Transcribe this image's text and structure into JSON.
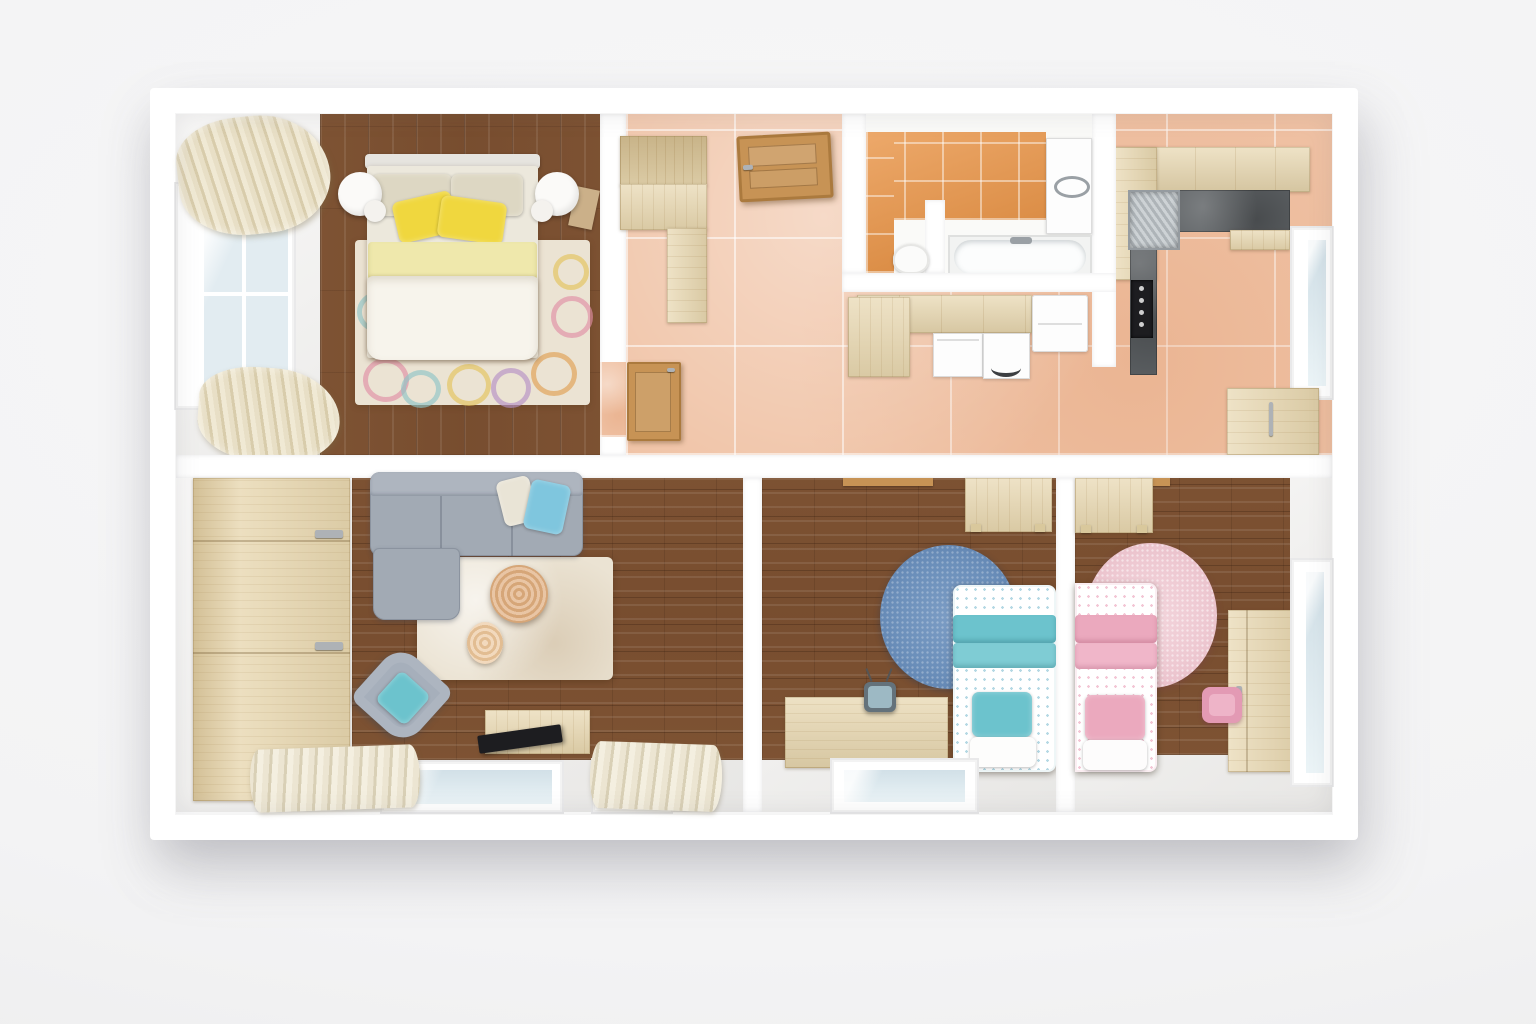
{
  "scene": {
    "kind": "3d-floor-plan-top-view-render",
    "description": "Top-down 3D render of a furnished apartment with main bedroom, hallway, bathroom, kitchen, living room and two kids bedrooms",
    "visible_text": []
  },
  "palette": {
    "bg": "#f4f4f5",
    "wall": "#ffffff",
    "floor_white": "#f0efed",
    "tile": "#f0c3a6",
    "wood_dark": "#7c5132",
    "wood_lite": "#e7d6ae",
    "counter_dark": "#5d6164",
    "orange": "#e9964a",
    "sofa": "#a2aab4",
    "teal": "#6cc3cd",
    "blue_pillow": "#7fc6de",
    "rug_cream": "#ebe3d3",
    "rug_blue": "#6b8fba",
    "rug_pink": "#eec9d2",
    "pink": "#eba9be",
    "yellow": "#f0d73e",
    "yellow_pale": "#efe8ac",
    "door_wood": "#c79355",
    "glass": "#e2ecf1",
    "curtain_1": "#e8dfc6",
    "curtain_2": "#d8ccab",
    "cream_pillow": "#ddd7c3",
    "table_wood": "#e2b285",
    "tv_black": "#1d1d20",
    "metal": "#c3c8cc"
  },
  "rooms": [
    {
      "id": "main-bedroom",
      "position": "top-left",
      "furniture": [
        "double-bed",
        "cream-pillows",
        "yellow-pillows",
        "round-nightstand-left",
        "round-nightstand-right",
        "patterned-rug",
        "window",
        "curtains"
      ]
    },
    {
      "id": "hallway",
      "position": "top-middle",
      "furniture": [
        "wardrobe-cabinet",
        "entrance-door",
        "bedroom-door"
      ]
    },
    {
      "id": "bathroom",
      "position": "top-center",
      "furniture": [
        "bathtub",
        "toilet",
        "wall-cabinet",
        "partition-wall",
        "orange-wall-tiles"
      ]
    },
    {
      "id": "kitchen",
      "position": "top-right",
      "furniture": [
        "l-shaped-counter",
        "sink",
        "cooktop",
        "fridge",
        "dishwasher",
        "washing-machine",
        "window",
        "small-cabinet"
      ]
    },
    {
      "id": "living-room",
      "position": "bottom-left",
      "furniture": [
        "corner-sofa",
        "blue-pillow",
        "cream-pillow",
        "coffee-table",
        "side-table",
        "armchair",
        "teal-pillow",
        "shaggy-rug",
        "wardrobe",
        "tv-board",
        "tv",
        "two-windows",
        "curtains"
      ]
    },
    {
      "id": "kids-room-blue",
      "position": "bottom-middle",
      "furniture": [
        "single-bed-teal",
        "round-blue-rug",
        "desk-top",
        "tv-table",
        "retro-tv",
        "window"
      ]
    },
    {
      "id": "kids-room-pink",
      "position": "bottom-right",
      "furniture": [
        "single-bed-pink",
        "round-pink-rug",
        "desk-top",
        "tall-wardrobe",
        "pink-chair",
        "window"
      ]
    }
  ]
}
